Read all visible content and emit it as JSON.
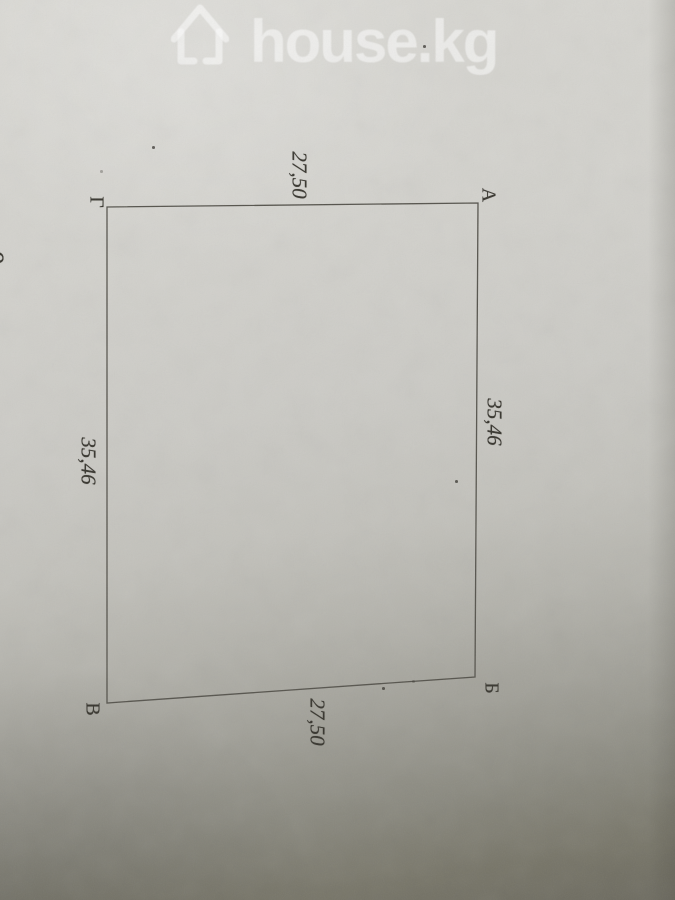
{
  "watermark": {
    "text": "house.kg",
    "icon": "house-outline-icon",
    "color": "rgba(255,255,255,0.55)"
  },
  "diagram": {
    "polygon_points": "107,207 478,203 475,677 107,703",
    "line_color": "#54524b",
    "ink_color": "#35332c",
    "corners": [
      {
        "label": "А"
      },
      {
        "label": "Б"
      },
      {
        "label": "В"
      },
      {
        "label": "Г"
      }
    ],
    "measurements": {
      "top": "27,50",
      "right": "35,46",
      "left": "35,46",
      "bottom": "27,50"
    },
    "edge_partial_text": "9"
  }
}
